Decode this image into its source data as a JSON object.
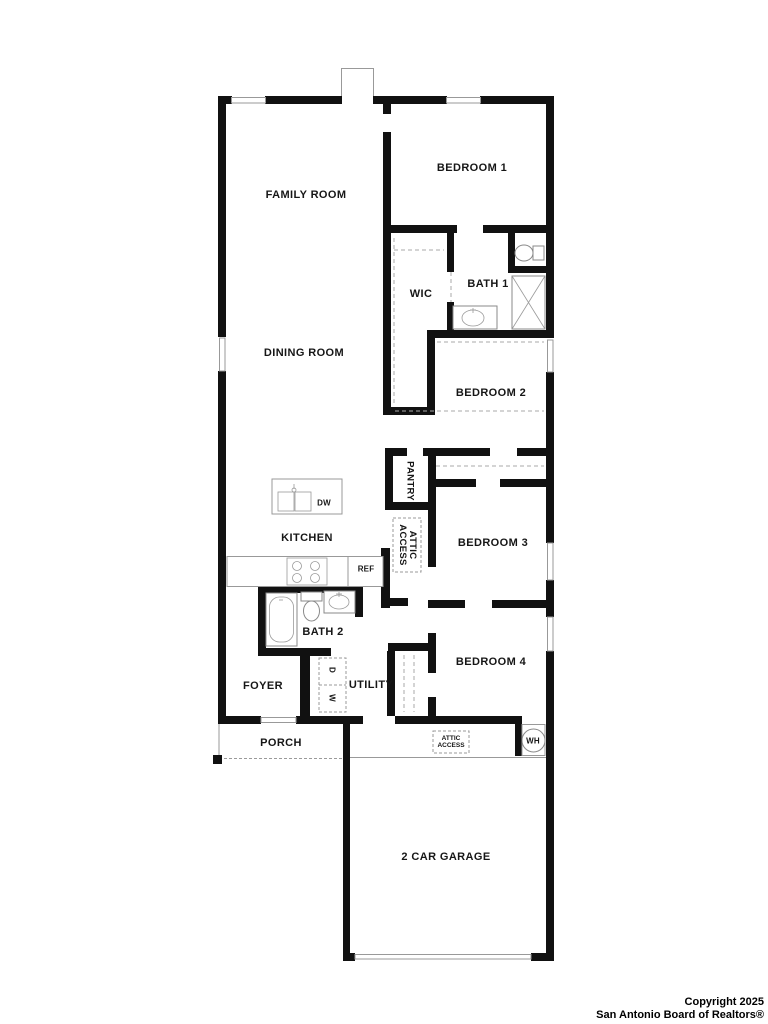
{
  "rooms": {
    "family_room": "FAMILY ROOM",
    "bedroom_1": "BEDROOM 1",
    "wic": "WIC",
    "bath_1": "BATH 1",
    "dining_room": "DINING ROOM",
    "bedroom_2": "BEDROOM 2",
    "pantry": "PANTRY",
    "kitchen": "KITCHEN",
    "bedroom_3": "BEDROOM 3",
    "bath_2": "BATH 2",
    "foyer": "FOYER",
    "utility": "UTILITY",
    "bedroom_4": "BEDROOM 4",
    "porch": "PORCH",
    "garage": "2 CAR GARAGE"
  },
  "labels": {
    "attic_line1": "ATTIC",
    "attic_line2": "ACCESS",
    "dishwasher": "DW",
    "refrigerator": "REF",
    "water_heater": "WH",
    "washer": "W",
    "dryer": "D"
  },
  "footer": {
    "copyright_line1": "Copyright 2025",
    "copyright_line2": "San Antonio Board of Realtors®"
  },
  "colors": {
    "wall": "#111111",
    "thin_line": "#999999",
    "dash_line": "#aaaaaa",
    "text": "#161616"
  }
}
